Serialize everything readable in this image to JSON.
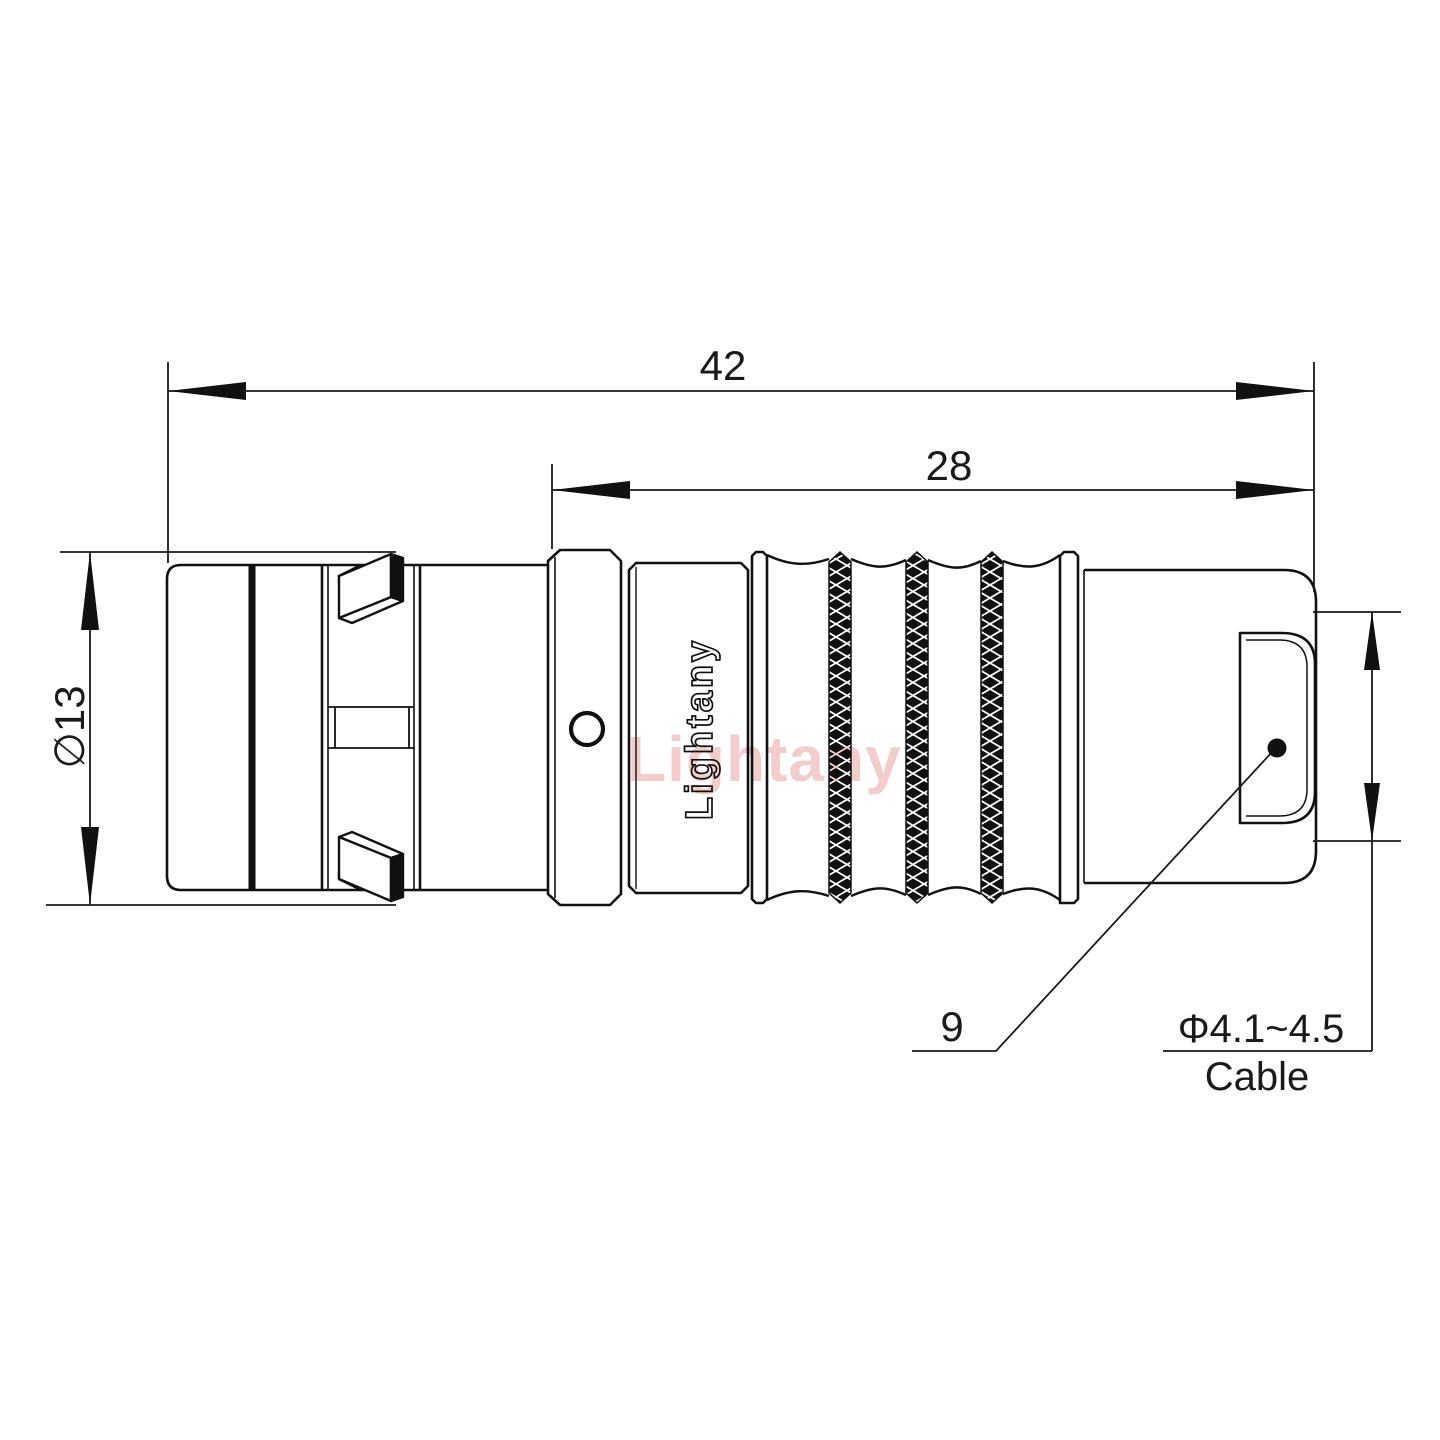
{
  "drawing": {
    "title": "connector-outline-drawing",
    "dimensions": {
      "overall_length": "42",
      "rear_length": "28",
      "body_diameter": "∅13",
      "nut_size": "9",
      "cable_diameter": "Φ4.1~4.5",
      "cable_label": "Cable"
    },
    "branding": {
      "logo_text": "Lightany",
      "watermark_text": "Lightany"
    },
    "colors": {
      "line": "#1a1a1a",
      "background": "#ffffff",
      "watermark_pink": "#e89a9a"
    }
  }
}
